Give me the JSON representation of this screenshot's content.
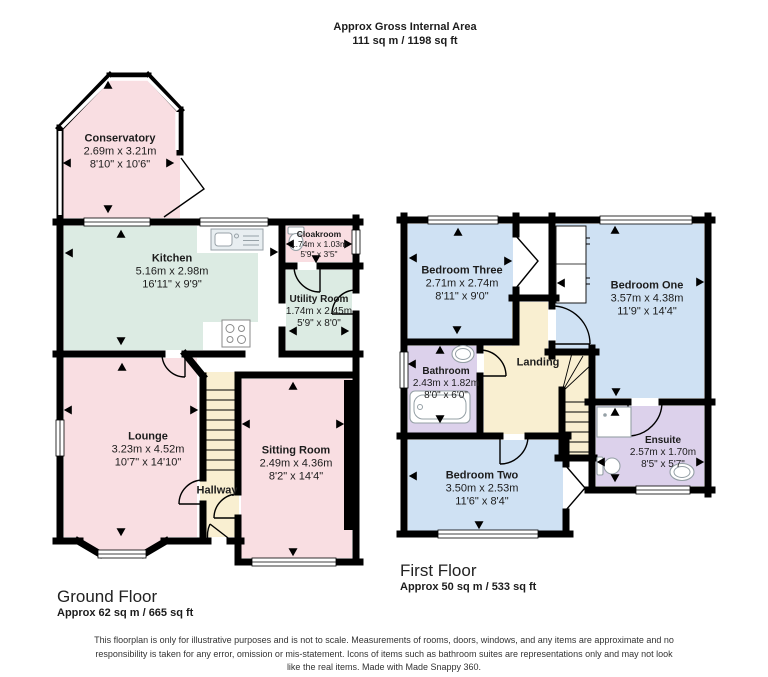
{
  "header": {
    "title": "Approx Gross Internal Area",
    "subtitle": "111 sq m / 1198 sq ft"
  },
  "colors": {
    "wall": "#000000",
    "pink": "#f9dee2",
    "green": "#dcebe3",
    "blue": "#cfe1f3",
    "purple": "#dcd1eb",
    "cream": "#f9efd1",
    "white": "#ffffff"
  },
  "ground_floor": {
    "title": "Ground Floor",
    "area": "Approx 62 sq m / 665 sq ft",
    "rooms": {
      "conservatory": {
        "name": "Conservatory",
        "metric": "2.69m x 3.21m",
        "imperial": "8'10\" x 10'6\""
      },
      "kitchen": {
        "name": "Kitchen",
        "metric": "5.16m x 2.98m",
        "imperial": "16'11\" x 9'9\""
      },
      "cloakroom": {
        "name": "Cloakroom",
        "metric": "1.74m x 1.03m",
        "imperial": "5'9\" x 3'5\""
      },
      "utility": {
        "name": "Utility Room",
        "metric": "1.74m x 2.45m",
        "imperial": "5'9\" x 8'0\""
      },
      "lounge": {
        "name": "Lounge",
        "metric": "3.23m x 4.52m",
        "imperial": "10'7\" x 14'10\""
      },
      "hallway": {
        "name": "Hallway"
      },
      "sitting": {
        "name": "Sitting Room",
        "metric": "2.49m x 4.36m",
        "imperial": "8'2\" x 14'4\""
      }
    }
  },
  "first_floor": {
    "title": "First Floor",
    "area": "Approx 50 sq m / 533 sq ft",
    "rooms": {
      "bedroom_three": {
        "name": "Bedroom Three",
        "metric": "2.71m x 2.74m",
        "imperial": "8'11\" x 9'0\""
      },
      "bedroom_one": {
        "name": "Bedroom One",
        "metric": "3.57m x 4.38m",
        "imperial": "11'9\" x 14'4\""
      },
      "bathroom": {
        "name": "Bathroom",
        "metric": "2.43m x 1.82m",
        "imperial": "8'0\" x 6'0\""
      },
      "landing": {
        "name": "Landing"
      },
      "bedroom_two": {
        "name": "Bedroom Two",
        "metric": "3.50m x 2.53m",
        "imperial": "11'6\" x 8'4\""
      },
      "ensuite": {
        "name": "Ensuite",
        "metric": "2.57m x 1.70m",
        "imperial": "8'5\" x 5'7\""
      }
    }
  },
  "footer": {
    "disclaimer": "This floorplan is only for illustrative purposes and is not to scale. Measurements of rooms, doors, windows, and any items are approximate and no responsibility is taken for any error, omission or mis-statement. Icons of items such as bathroom suites are representations only and may not look like the real items. Made with Made Snappy 360."
  }
}
